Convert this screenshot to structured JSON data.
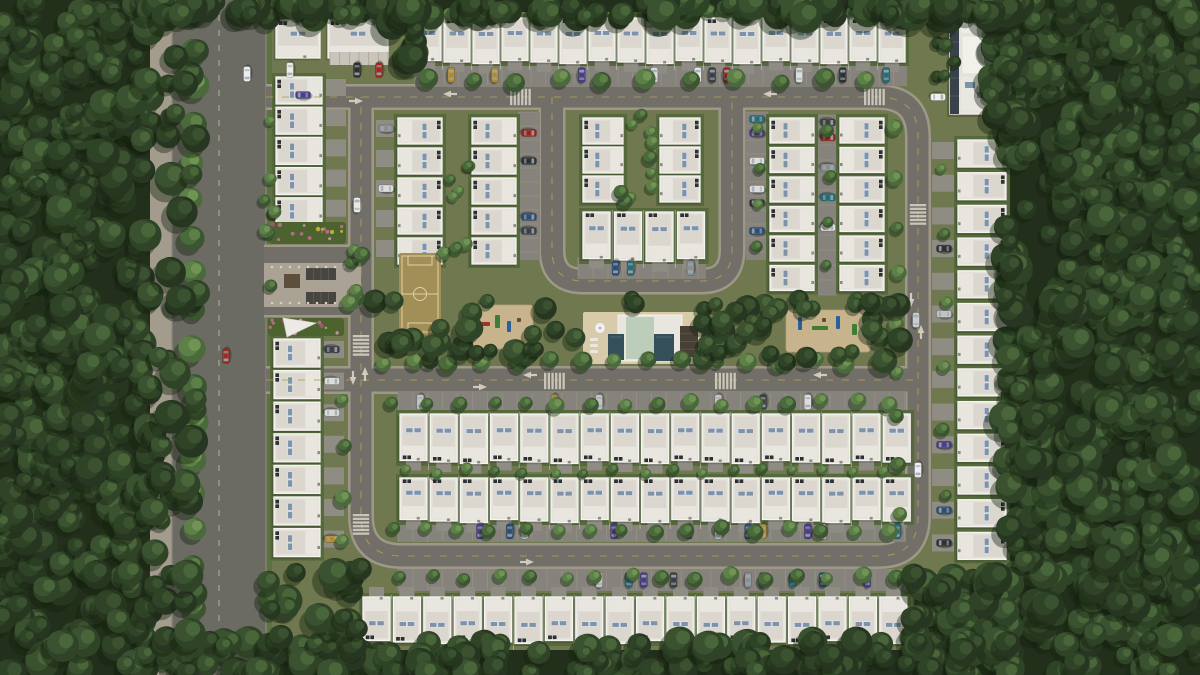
{
  "scene": {
    "width": 1200,
    "height": 675,
    "title": "Aerial render of a gated residential community with white-roof townhouses surrounded by dense forest"
  },
  "palette": {
    "ground": "#6f784e",
    "lawn": "#55693c",
    "verge": "#5d7242",
    "forest_base": "#222f1a",
    "road": "#716f68",
    "road_main": "#6b6a63",
    "curb": "#9f9889",
    "sidewalk": "#a39c8d",
    "park": "#85837b",
    "stall": "#9c978c",
    "drive": "#8f8c84",
    "plaza": "#a9a295",
    "house": "#e6e3dc",
    "house_edge": "#f5f4f0",
    "house_inner": "#dbd7cf",
    "panel": "#7e93a9",
    "sand": "#c7b48c",
    "deck": "#d8cbaa",
    "pool": "#35505b",
    "club_roof": "#bccdb9",
    "field": "#a28e57",
    "field_line": "#ddd3a8",
    "pergola": "#46453f",
    "kiosk": "#5d4f3b",
    "marking_white": "#d8d5c7",
    "marking_yellow": "#b0a052",
    "tree_forest": [
      "#273620",
      "#2f4426",
      "#3a5230",
      "#49653a",
      "#587747"
    ],
    "tree_bright": [
      "#3a5530",
      "#4a6a3c",
      "#5d8048",
      "#719455"
    ],
    "flower_colors": [
      "#bd6f8c",
      "#cf93a8",
      "#a75573",
      "#c7b23f"
    ],
    "car_colors": [
      "#ebebe9",
      "#dcdedd",
      "#c2c4c4",
      "#2e3134",
      "#3c3f44",
      "#99251e",
      "#2e4d74",
      "#256b78",
      "#b08a30",
      "#4a3c85",
      "#8a8f93"
    ]
  },
  "ground": {
    "community": [
      150,
      0,
      860,
      675
    ],
    "verge": [
      266,
      0,
      6,
      675
    ]
  },
  "avenue": {
    "sidewalk": [
      150,
      0,
      22,
      675
    ],
    "road": [
      172,
      0,
      94,
      675
    ],
    "dash_x": 219
  },
  "roads": {
    "paths": [
      {
        "d": "M266 97 H878 Q918 97 918 137 V516 Q918 556 878 556 H402 Q361 556 361 516 V97",
        "w": 21
      },
      {
        "d": "M552 97 V250 Q552 281 583 281 H701 Q732 281 732 250 V97",
        "w": 22
      },
      {
        "d": "M266 380 H918",
        "w": 23
      },
      {
        "d": "M264 255 H361",
        "w": 16
      },
      {
        "d": "M264 307 H361",
        "w": 16
      }
    ]
  },
  "markings": {
    "dash_paths": [
      "M266 97 H878 Q918 97 918 137 V516 Q918 556 878 556 H402 Q361 556 361 516 V97",
      "M552 97 V250 Q552 281 583 281 H701 Q732 281 732 250 V97",
      "M266 380 H918"
    ],
    "arrows": [
      [
        450,
        94,
        "w"
      ],
      [
        770,
        94,
        "w"
      ],
      [
        356,
        101,
        "e"
      ],
      [
        530,
        375,
        "w"
      ],
      [
        820,
        375,
        "w"
      ],
      [
        480,
        387,
        "e"
      ],
      [
        527,
        562,
        "e"
      ],
      [
        353,
        378,
        "s"
      ],
      [
        365,
        374,
        "n"
      ],
      [
        911,
        300,
        "s"
      ],
      [
        921,
        332,
        "n"
      ]
    ],
    "crosswalks": [
      [
        519,
        97,
        "h"
      ],
      [
        873,
        97,
        "h"
      ],
      [
        553,
        381,
        "h"
      ],
      [
        724,
        381,
        "h"
      ],
      [
        361,
        344,
        "v"
      ],
      [
        361,
        523,
        "v"
      ],
      [
        918,
        213,
        "v"
      ]
    ]
  },
  "house_rows": [
    {
      "id": "top-row",
      "x": 415,
      "y": 18,
      "w": 26,
      "h": 44,
      "n": 17,
      "step": 29,
      "axis": "h",
      "front": "s",
      "ac": "n"
    },
    {
      "id": "row-b",
      "x": 400,
      "y": 414,
      "w": 27,
      "h": 48,
      "n": 17,
      "step": 30.2,
      "axis": "h",
      "front": "s",
      "ac": "s"
    },
    {
      "id": "row-c",
      "x": 400,
      "y": 478,
      "w": 27,
      "h": 43,
      "n": 17,
      "step": 30.2,
      "axis": "h",
      "front": "s",
      "ac": "n"
    },
    {
      "id": "row-d",
      "x": 363,
      "y": 597,
      "w": 27,
      "h": 45,
      "n": 18,
      "step": 30.4,
      "axis": "h",
      "front": "n",
      "ac": "s"
    },
    {
      "id": "left-col-upper",
      "x": 276,
      "y": 77,
      "w": 46,
      "h": 27,
      "n": 5,
      "step": 30.2,
      "axis": "v",
      "front": "e",
      "ac": "w"
    },
    {
      "id": "left-col-lower",
      "x": 274,
      "y": 339,
      "w": 46,
      "h": 28,
      "n": 7,
      "step": 31.6,
      "axis": "v",
      "front": "e",
      "ac": "w"
    },
    {
      "id": "right-col",
      "x": 958,
      "y": 140,
      "w": 48,
      "h": 27,
      "n": 13,
      "step": 32.7,
      "axis": "v",
      "front": "w",
      "ac": "e"
    },
    {
      "id": "block-a",
      "x": 398,
      "y": 118,
      "w": 44,
      "h": 26,
      "n": 5,
      "step": 30,
      "axis": "v",
      "front": "w",
      "ac": "e"
    },
    {
      "id": "block-b",
      "x": 472,
      "y": 118,
      "w": 44,
      "h": 26,
      "n": 5,
      "step": 30,
      "axis": "v",
      "front": "e",
      "ac": "w"
    },
    {
      "id": "quad-left",
      "x": 583,
      "y": 118,
      "w": 40,
      "h": 26,
      "n": 3,
      "step": 29,
      "axis": "v",
      "front": "e",
      "ac": "w"
    },
    {
      "id": "quad-right",
      "x": 660,
      "y": 118,
      "w": 40,
      "h": 26,
      "n": 3,
      "step": 29,
      "axis": "v",
      "front": "w",
      "ac": "e"
    },
    {
      "id": "quad-bottom",
      "x": 583,
      "y": 212,
      "w": 27,
      "h": 48,
      "n": 4,
      "step": 31.5,
      "axis": "h",
      "front": "s",
      "ac": "n"
    },
    {
      "id": "col-c",
      "x": 770,
      "y": 118,
      "w": 44,
      "h": 25,
      "n": 6,
      "step": 29.5,
      "axis": "v",
      "front": "e",
      "ac": "w"
    },
    {
      "id": "col-d",
      "x": 840,
      "y": 118,
      "w": 44,
      "h": 25,
      "n": 6,
      "step": 29.5,
      "axis": "v",
      "front": "w",
      "ac": "e"
    }
  ],
  "parking": [
    [
      "strip",
      415,
      64,
      492,
      22,
      "h",
      14.5,
      0.34,
      "n"
    ],
    [
      "strip",
      398,
      392,
      508,
      20,
      "h",
      14.9,
      0.3,
      "s"
    ],
    [
      "strip",
      398,
      521,
      508,
      21,
      "h",
      14.9,
      0.28,
      "s"
    ],
    [
      "strip",
      398,
      569,
      508,
      22,
      "h",
      14.9,
      0.3,
      "n"
    ],
    [
      "strip",
      518,
      112,
      148,
      22,
      "v",
      14,
      0.38,
      "e"
    ],
    [
      "strip",
      746,
      112,
      148,
      22,
      "v",
      14,
      0.42,
      "w"
    ],
    [
      "strip",
      578,
      257,
      128,
      22,
      "h",
      15,
      0.5,
      "s"
    ],
    [
      "strip",
      818,
      115,
      180,
      20,
      "v",
      15,
      0.32,
      "e"
    ],
    [
      "drive",
      322,
      77,
      5,
      30.2,
      "v",
      24,
      0.55,
      "e"
    ],
    [
      "drive",
      320,
      339,
      7,
      31.6,
      "v",
      24,
      0.5,
      "e"
    ],
    [
      "drive",
      932,
      140,
      13,
      32.7,
      "v",
      24,
      0.5,
      "w"
    ],
    [
      "drive",
      376,
      118,
      5,
      30,
      "v",
      20,
      0.45,
      "w"
    ]
  ],
  "buildings": {
    "nw_a": [
      276,
      20,
      44,
      38
    ],
    "nw_b": [
      328,
      20,
      60,
      38
    ],
    "carport": [
      330,
      52,
      58,
      13
    ],
    "condo": [
      950,
      6,
      47,
      108
    ]
  },
  "amenities": {
    "soccer": [
      399,
      253,
      42,
      82
    ],
    "pg1": {
      "rect": [
        471,
        305,
        62,
        44
      ],
      "equip": [
        [
          480,
          322,
          10,
          4,
          "#a03326"
        ],
        [
          495,
          315,
          5,
          13,
          "#3f7d34"
        ],
        [
          507,
          321,
          4,
          11,
          "#2d5e9e"
        ],
        [
          517,
          318,
          4,
          4,
          "#6b4a32"
        ]
      ]
    },
    "pg2": {
      "rect": [
        786,
        310,
        84,
        42
      ],
      "equip": [
        [
          798,
          317,
          4,
          13,
          "#2d5e9e"
        ],
        [
          812,
          326,
          16,
          4,
          "#3f7d34"
        ],
        [
          836,
          316,
          4,
          13,
          "#2d5e9e"
        ],
        [
          852,
          324,
          5,
          11,
          "#3f7d34"
        ],
        [
          822,
          318,
          4,
          4,
          "#6b4a32"
        ]
      ]
    },
    "pool": {
      "deck": [
        583,
        312,
        118,
        52
      ],
      "core": [
        618,
        315,
        64,
        46
      ],
      "roof": [
        626,
        317,
        28,
        42
      ],
      "pools": [
        [
          608,
          334,
          16,
          26
        ],
        [
          654,
          334,
          20,
          27
        ]
      ],
      "pavilion": [
        680,
        326,
        18,
        31
      ],
      "umbrella": [
        600,
        328,
        5.5
      ],
      "loungers": [
        [
          590,
          338
        ],
        [
          590,
          344
        ],
        [
          590,
          350
        ]
      ]
    },
    "plaza": {
      "island": [
        264,
        263,
        97,
        44
      ],
      "pergolas": [
        [
          306,
          268,
          30,
          12
        ],
        [
          306,
          292,
          30,
          12
        ]
      ],
      "kiosk": [
        284,
        274,
        16,
        14
      ],
      "flowers": [
        [
          270,
          222,
          76,
          22
        ],
        [
          268,
          318,
          76,
          18
        ]
      ],
      "bollard_rows": [
        267,
        303
      ],
      "office_tri": [
        [
          283,
          318
        ],
        [
          316,
          323
        ],
        [
          287,
          337
        ]
      ]
    }
  },
  "cars": [
    [
      247,
      74,
      "s",
      "#eceff0"
    ],
    [
      226,
      356,
      "s",
      "#9b2c24"
    ],
    [
      303,
      95,
      "w",
      "#4a3f8f"
    ],
    [
      938,
      97,
      "e",
      "#f0f0ee"
    ],
    [
      357,
      205,
      "n",
      "#e8e8e6"
    ],
    [
      916,
      320,
      "n",
      "#c9ccce"
    ],
    [
      290,
      70,
      "s",
      "#ececea"
    ],
    [
      357,
      70,
      "s",
      "#2c2e32"
    ],
    [
      379,
      70,
      "s",
      "#a0271f"
    ],
    [
      918,
      470,
      "s",
      "#edeff0"
    ]
  ],
  "trees": {
    "rows": [
      [
        193,
        14,
        18,
        0,
        37,
        12
      ],
      [
        428,
        80,
        11,
        44,
        0,
        9
      ],
      [
        385,
        362,
        16,
        33,
        0,
        8
      ],
      [
        394,
        403,
        16,
        33,
        0,
        7
      ],
      [
        392,
        530,
        16,
        33,
        0,
        7
      ],
      [
        400,
        577,
        16,
        33,
        0,
        7
      ],
      [
        404,
        471,
        17,
        30,
        0,
        5
      ],
      [
        419,
        12,
        17,
        29,
        0,
        6
      ],
      [
        897,
        130,
        9,
        0,
        48,
        7
      ],
      [
        757,
        127,
        4,
        0,
        40,
        6
      ],
      [
        829,
        132,
        4,
        0,
        45,
        6
      ],
      [
        944,
        168,
        6,
        0,
        66,
        6
      ],
      [
        343,
        402,
        4,
        0,
        47,
        7
      ],
      [
        268,
        124,
        4,
        0,
        54,
        6
      ]
    ],
    "clusters": [
      [
        620,
        112,
        42,
        92,
        10,
        5,
        8,
        "b"
      ],
      [
        444,
        116,
        26,
        138,
        8,
        5,
        8,
        "b"
      ],
      [
        374,
        298,
        528,
        64,
        52,
        7,
        13,
        "f"
      ],
      [
        702,
        298,
        198,
        60,
        20,
        7,
        12,
        "f"
      ],
      [
        936,
        18,
        20,
        64,
        5,
        5,
        8,
        "f"
      ],
      [
        348,
        220,
        18,
        112,
        6,
        6,
        9,
        "b"
      ],
      [
        262,
        190,
        16,
        44,
        4,
        5,
        8,
        "b"
      ]
    ],
    "exclusions": [
      [
        396,
        250,
        48,
        88
      ],
      [
        580,
        308,
        124,
        58
      ],
      [
        468,
        302,
        68,
        48
      ],
      [
        783,
        306,
        90,
        48
      ]
    ]
  },
  "forest": {
    "seed": 20240613,
    "base": [
      [
        0,
        0,
        150,
        675
      ],
      [
        1008,
        0,
        192,
        675
      ],
      [
        997,
        0,
        14,
        122
      ],
      [
        915,
        580,
        95,
        95
      ],
      [
        150,
        0,
        860,
        12
      ],
      [
        150,
        650,
        860,
        25
      ]
    ],
    "canopy": [
      [
        0,
        0,
        152,
        675,
        360
      ],
      [
        1005,
        0,
        195,
        675,
        500
      ],
      [
        990,
        0,
        32,
        126,
        30
      ],
      [
        912,
        572,
        102,
        103,
        60
      ],
      [
        150,
        0,
        862,
        18,
        110
      ],
      [
        150,
        640,
        860,
        35,
        150
      ],
      [
        386,
        2,
        32,
        60,
        12
      ],
      [
        146,
        0,
        52,
        675,
        55
      ],
      [
        262,
        568,
        102,
        74,
        18
      ]
    ]
  }
}
